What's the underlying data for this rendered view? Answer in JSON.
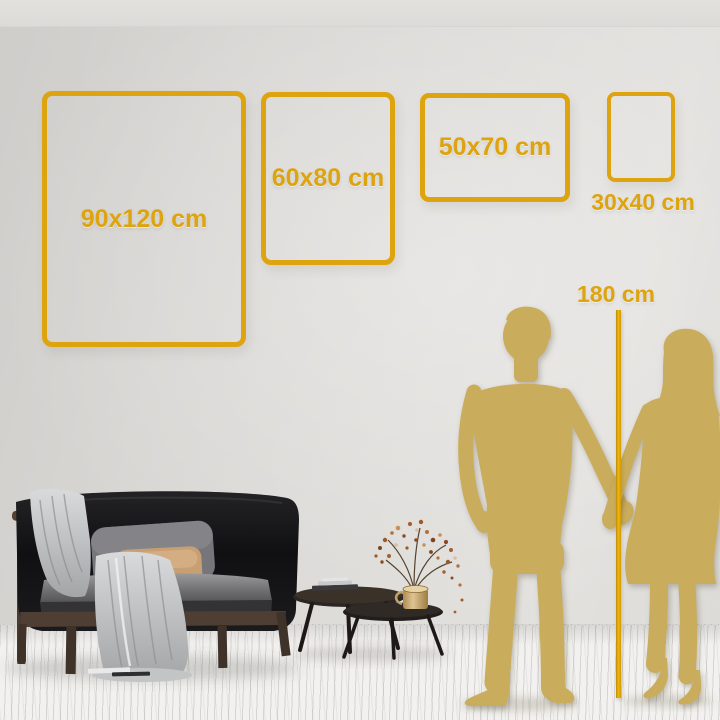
{
  "size_guide": {
    "frames": [
      {
        "id": "90x120",
        "label": "90x120 cm"
      },
      {
        "id": "60x80",
        "label": "60x80 cm"
      },
      {
        "id": "50x70",
        "label": "50x70 cm"
      },
      {
        "id": "30x40",
        "label": "30x40 cm"
      }
    ],
    "height_marker": {
      "label": "180 cm"
    }
  },
  "colors": {
    "accent_gold": "#DDA410",
    "silhouette_gold": "#C9AC5C",
    "wall": "#DCDAD7",
    "floor": "#F2F1EF"
  },
  "scene_elements": {
    "people": [
      "man-silhouette",
      "woman-silhouette"
    ],
    "furniture": [
      "sofa",
      "throw-blanket",
      "pillows",
      "nesting-coffee-tables",
      "brass-vase-dried-plant",
      "books"
    ]
  }
}
